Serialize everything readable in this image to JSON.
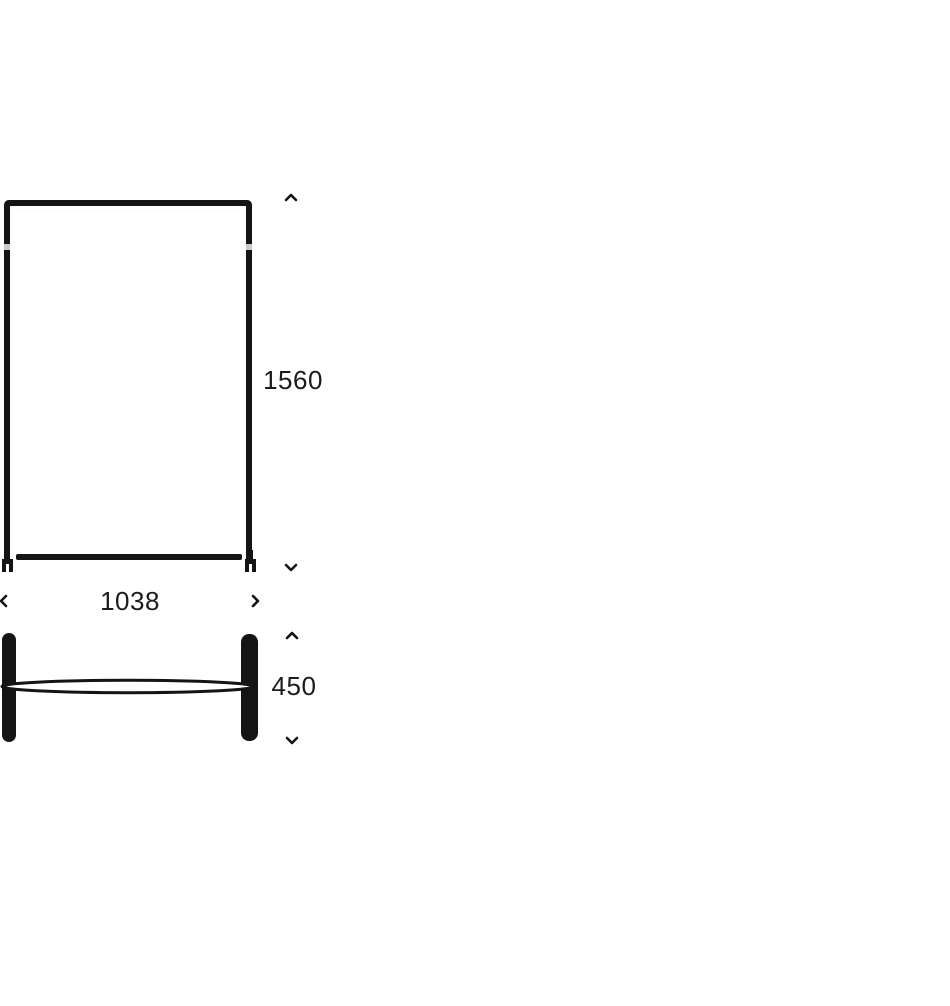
{
  "canvas": {
    "background": "#ffffff",
    "ink": "#141414"
  },
  "drawing": {
    "kind": "product-dimension-diagram",
    "views": {
      "front": "rectangular outline with two small feet",
      "base": "axle bar with two rounded end caps"
    }
  },
  "dimensions": {
    "height": {
      "label": "1560",
      "orientation": "vertical"
    },
    "width": {
      "label": "1038",
      "orientation": "horizontal"
    },
    "depth": {
      "label": "450",
      "orientation": "vertical"
    }
  },
  "icons": {
    "arrow_up": "^",
    "arrow_down": "v",
    "arrow_left": "<",
    "arrow_right": ">"
  }
}
